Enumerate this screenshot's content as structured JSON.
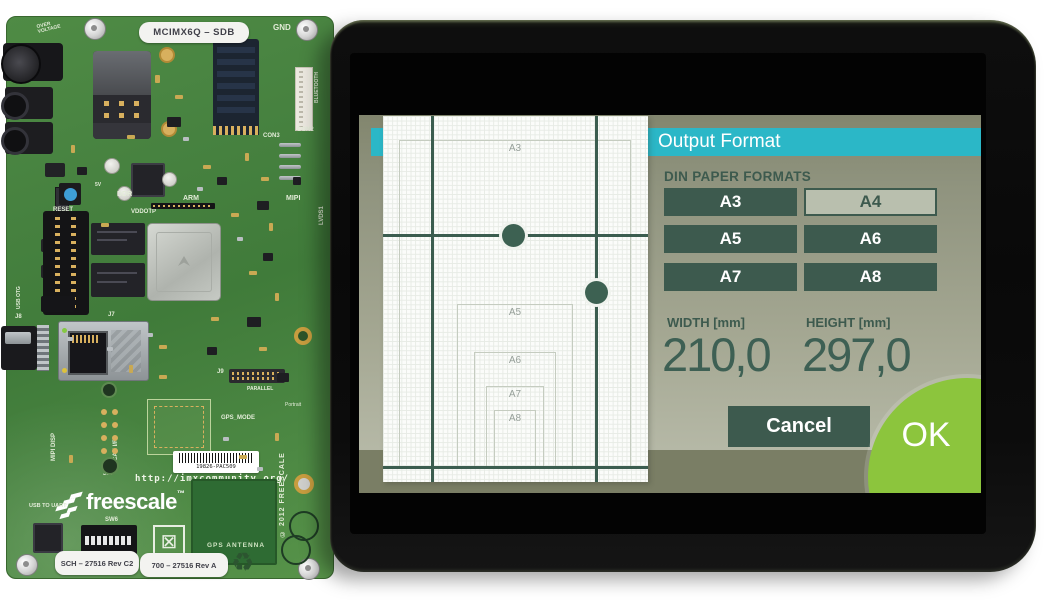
{
  "board": {
    "name_sticker": "MCIMX6Q – SDB",
    "sch_sticker": "SCH – 27516 Rev C2",
    "rev_sticker": "700 – 27516 Rev A",
    "barcode_text": "19826-PAC509",
    "url": "http://imxcommunity.org/",
    "brand": "freescale",
    "brand_tm": "™",
    "icons": {
      "recycle": "♻",
      "weee": "⊠"
    },
    "labels": {
      "gnd": "GND",
      "over_voltage": "OVER VOLTAGE",
      "con2": "CON2",
      "con3": "CON3",
      "bluetooth": "BLUETOOTH",
      "mipi": "MIPI",
      "lvds1": "LVDS1",
      "arm": "ARM",
      "ddr": "DDR",
      "vddotp": "VDDOTP",
      "five_v": "5V",
      "reset": "RESET",
      "mipi_disp": "MIPI DISP",
      "usb_otg": "USB OTG",
      "j7": "J7",
      "j8": "J8",
      "j9": "J9",
      "parallel": "PARALLEL",
      "portrait": "Portrait",
      "gps_mode": "GPS_MODE",
      "can_if": "CAN I/F",
      "j10": "J10",
      "usb_to_uart": "USB TO UART",
      "sw6": "SW6",
      "boot": "BOOT",
      "gps_antenna": "GPS ANTENNA",
      "copyright": "© 2012 FREESCALE"
    }
  },
  "tablet": {
    "dialog": {
      "title": "Output Format",
      "section_label": "DIN PAPER FORMATS",
      "format_buttons": [
        "A3",
        "A4",
        "A5",
        "A6",
        "A7",
        "A8"
      ],
      "selected_format": "A4",
      "width_label": "WIDTH [mm]",
      "height_label": "HEIGHT [mm]",
      "width_value": "210,0",
      "height_value": "297,0",
      "cancel_label": "Cancel",
      "ok_label": "OK"
    },
    "preview": {
      "labels": [
        "A3",
        "A4",
        "A5",
        "A6",
        "A7",
        "A8"
      ]
    },
    "colors": {
      "titlebar_cyan": "#2bb7c7",
      "button_green": "#3d5a4e",
      "selected_bg": "#b9bfae",
      "ok_green": "#8cc53d",
      "dialog_olive_top": "#82866e",
      "dialog_olive_bottom": "#b6b9a7",
      "footer_olive": "#7a7e65",
      "guide_green": "#3b5d4f"
    }
  }
}
